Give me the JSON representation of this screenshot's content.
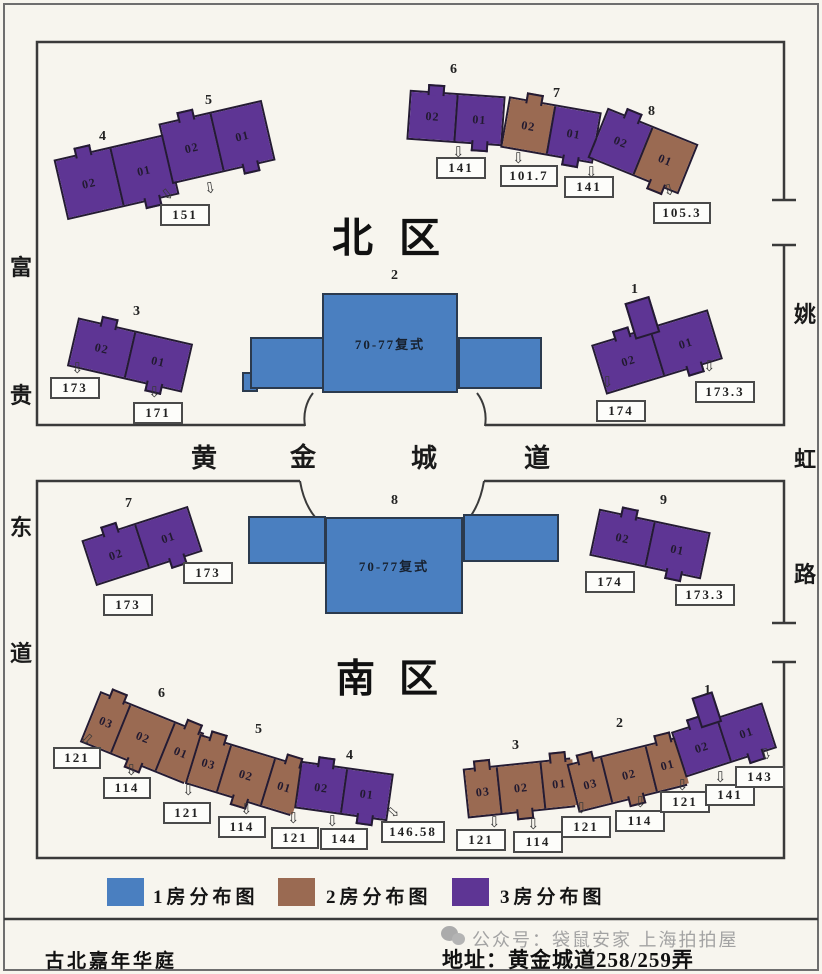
{
  "meta": {
    "community_name": "古北嘉年华庭",
    "address_label": "地址：黄金城道258/259弄",
    "watermark": "公众号：袋鼠安家 上海拍拍屋"
  },
  "colors": {
    "room1": "#4a7fc0",
    "room2": "#9a6a52",
    "room3": "#5e3594",
    "line": "#3a3a3a",
    "bg": "#f7f5ee"
  },
  "zones": {
    "north_title": "北区",
    "south_title": "南区"
  },
  "streets": {
    "west": [
      "富",
      "贵",
      "东",
      "道"
    ],
    "middle": [
      "黄",
      "金",
      "城",
      "道"
    ],
    "east": [
      "姚",
      "虹",
      "路"
    ]
  },
  "duplex_label": "70-77复式",
  "icons": {
    "down_arrow": "⇩"
  },
  "legend": [
    {
      "type": "room1",
      "label": "1房分布图"
    },
    {
      "type": "room2",
      "label": "2房分布图"
    },
    {
      "type": "room3",
      "label": "3房分布图"
    }
  ],
  "buildings": [
    {
      "id": "n4",
      "label": "4",
      "units": [
        {
          "no": "02",
          "type": "room3"
        },
        {
          "no": "01",
          "type": "room3"
        }
      ]
    },
    {
      "id": "n5",
      "label": "5",
      "units": [
        {
          "no": "02",
          "type": "room3"
        },
        {
          "no": "01",
          "type": "room3"
        }
      ]
    },
    {
      "id": "n6",
      "label": "6",
      "units": [
        {
          "no": "02",
          "type": "room3"
        },
        {
          "no": "01",
          "type": "room3"
        }
      ]
    },
    {
      "id": "n7",
      "label": "7",
      "units": [
        {
          "no": "02",
          "type": "room2"
        },
        {
          "no": "01",
          "type": "room3"
        }
      ]
    },
    {
      "id": "n8",
      "label": "8",
      "units": [
        {
          "no": "02",
          "type": "room3"
        },
        {
          "no": "01",
          "type": "room2"
        }
      ]
    },
    {
      "id": "n3",
      "label": "3",
      "units": [
        {
          "no": "02",
          "type": "room3"
        },
        {
          "no": "01",
          "type": "room3"
        }
      ]
    },
    {
      "id": "n1",
      "label": "1",
      "units": [
        {
          "no": "02",
          "type": "room3"
        },
        {
          "no": "01",
          "type": "room3"
        }
      ]
    },
    {
      "id": "n2",
      "label": "2",
      "type": "room1"
    },
    {
      "id": "s7",
      "label": "7",
      "units": [
        {
          "no": "02",
          "type": "room3"
        },
        {
          "no": "01",
          "type": "room3"
        }
      ]
    },
    {
      "id": "s8",
      "label": "8",
      "type": "room1"
    },
    {
      "id": "s9",
      "label": "9",
      "units": [
        {
          "no": "02",
          "type": "room3"
        },
        {
          "no": "01",
          "type": "room3"
        }
      ]
    },
    {
      "id": "s6",
      "label": "6",
      "units": [
        {
          "no": "03",
          "type": "room2"
        },
        {
          "no": "02",
          "type": "room2"
        },
        {
          "no": "01",
          "type": "room2"
        }
      ]
    },
    {
      "id": "s5",
      "label": "5",
      "units": [
        {
          "no": "03",
          "type": "room2"
        },
        {
          "no": "02",
          "type": "room2"
        },
        {
          "no": "01",
          "type": "room2"
        }
      ]
    },
    {
      "id": "s4",
      "label": "4",
      "units": [
        {
          "no": "02",
          "type": "room3"
        },
        {
          "no": "01",
          "type": "room3"
        }
      ]
    },
    {
      "id": "s3",
      "label": "3",
      "units": [
        {
          "no": "03",
          "type": "room2"
        },
        {
          "no": "02",
          "type": "room2"
        },
        {
          "no": "01",
          "type": "room2"
        }
      ]
    },
    {
      "id": "s2",
      "label": "2",
      "units": [
        {
          "no": "03",
          "type": "room2"
        },
        {
          "no": "02",
          "type": "room2"
        },
        {
          "no": "01",
          "type": "room2"
        }
      ]
    },
    {
      "id": "s1",
      "label": "1",
      "units": [
        {
          "no": "02",
          "type": "room3"
        },
        {
          "no": "01",
          "type": "room3"
        }
      ]
    }
  ],
  "area_labels": [
    {
      "id": "n151",
      "value": "151"
    },
    {
      "id": "n141a",
      "value": "141"
    },
    {
      "id": "n101_7",
      "value": "101.7"
    },
    {
      "id": "n141b",
      "value": "141"
    },
    {
      "id": "n105_3",
      "value": "105.3"
    },
    {
      "id": "n173",
      "value": "173"
    },
    {
      "id": "n171",
      "value": "171"
    },
    {
      "id": "n174",
      "value": "174"
    },
    {
      "id": "n173_3",
      "value": "173.3"
    },
    {
      "id": "s173a",
      "value": "173"
    },
    {
      "id": "s173b",
      "value": "173"
    },
    {
      "id": "s174",
      "value": "174"
    },
    {
      "id": "s173_3",
      "value": "173.3"
    },
    {
      "id": "sl121a",
      "value": "121"
    },
    {
      "id": "sl114a",
      "value": "114"
    },
    {
      "id": "sl121b",
      "value": "121"
    },
    {
      "id": "sl114b",
      "value": "114"
    },
    {
      "id": "sl121c",
      "value": "121"
    },
    {
      "id": "sl144",
      "value": "144"
    },
    {
      "id": "sl146_58",
      "value": "146.58"
    },
    {
      "id": "sr121a",
      "value": "121"
    },
    {
      "id": "sr114a",
      "value": "114"
    },
    {
      "id": "sr121b",
      "value": "121"
    },
    {
      "id": "sr114b",
      "value": "114"
    },
    {
      "id": "sr121c",
      "value": "121"
    },
    {
      "id": "sr141",
      "value": "141"
    },
    {
      "id": "sr143",
      "value": "143"
    }
  ]
}
